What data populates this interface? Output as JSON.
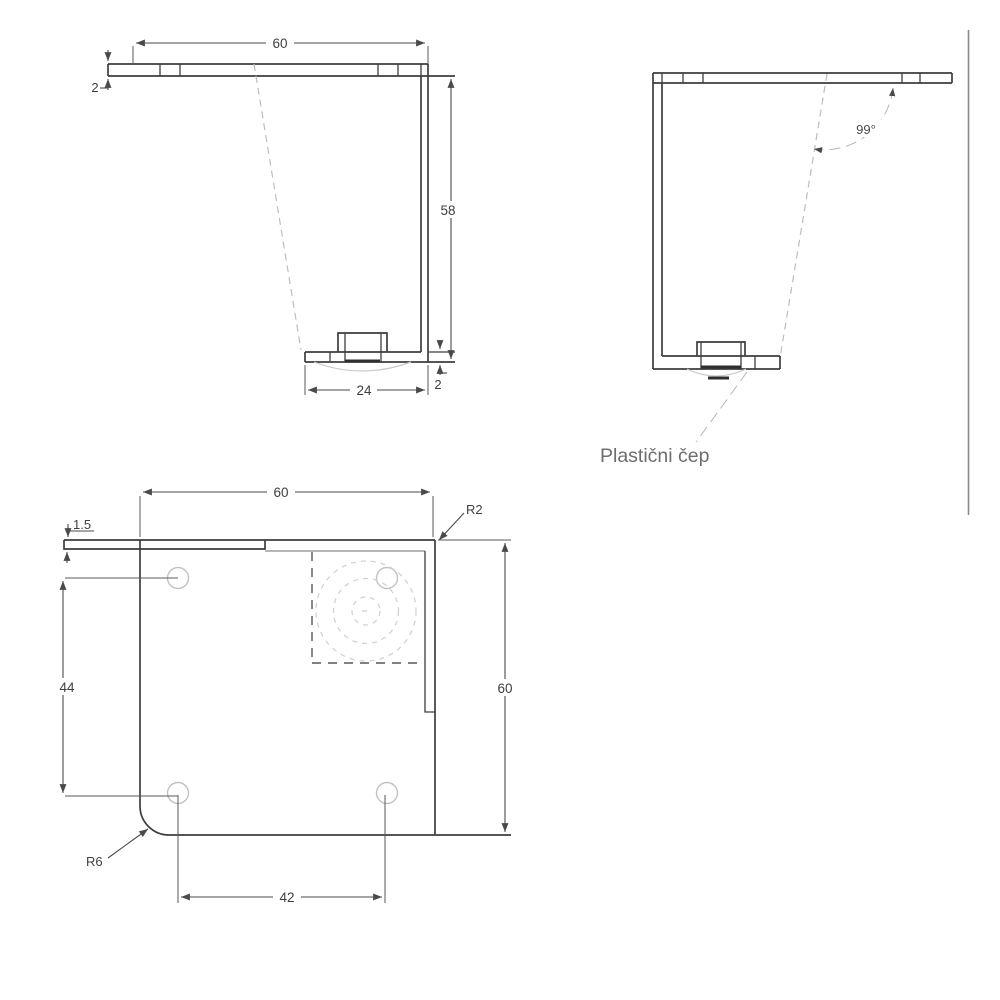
{
  "views": {
    "front": {
      "top_width": "60",
      "plate_thickness": "2",
      "height": "58",
      "foot_width": "24",
      "foot_thickness": "2"
    },
    "angled": {
      "angle": "99°",
      "cap_label": "Plastični čep"
    },
    "plan": {
      "top_width": "60",
      "corner_radius_small": "R2",
      "edge_offset": "1.5",
      "hole_spacing_vertical": "44",
      "side_height": "60",
      "hole_spacing_horizontal": "42",
      "corner_radius_large": "R6"
    }
  },
  "colors": {
    "outline": "#3d3d3d",
    "dimension": "#4a4a4a",
    "light_gray": "#c9c9c9",
    "label_gray": "#6e6e6e",
    "background": "#ffffff"
  }
}
